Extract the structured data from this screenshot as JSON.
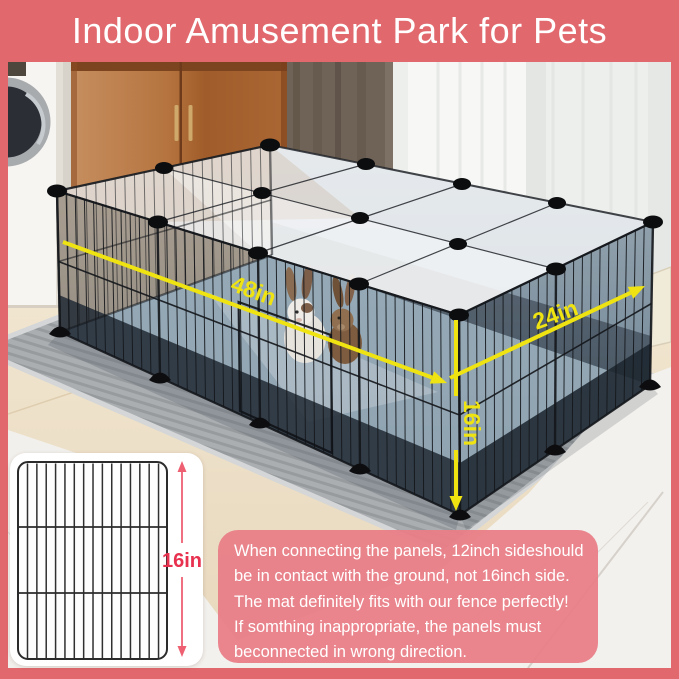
{
  "banner": {
    "title": "Indoor Amusement Park for Pets"
  },
  "dimensions": {
    "length": "48in",
    "depth": "24in",
    "height": "16in"
  },
  "inset_panel": {
    "height_label": "16in"
  },
  "note": {
    "lines": [
      "When connecting the panels, 12inch sideshould",
      "be in contact with the ground, not 16inch side.",
      "The mat definitely fits with our fence perfectly!",
      "If somthing inappropriate, the panels must",
      "beconnected in wrong direction."
    ]
  },
  "colors": {
    "banner_pink": "#e1696e",
    "note_pink": "#e9808a",
    "accent_red": "#e8304f",
    "arrow_yellow": "#efe412"
  }
}
